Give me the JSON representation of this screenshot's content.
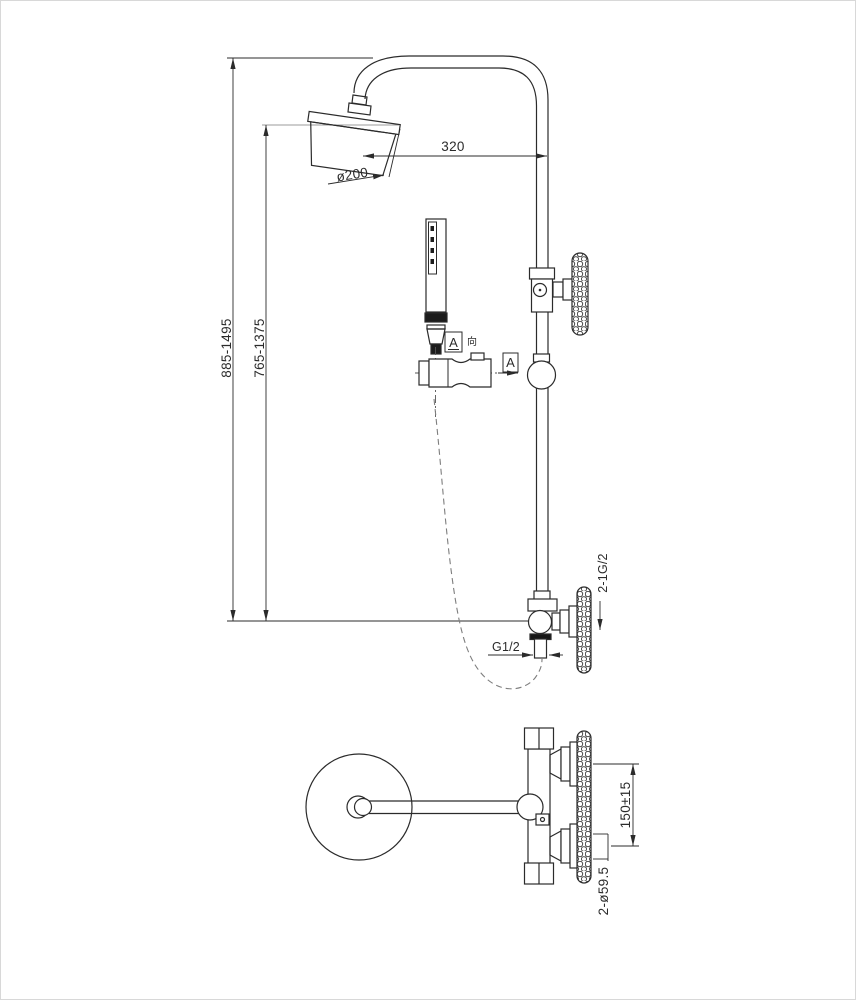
{
  "meta": {
    "drawing_type": "shower-column-technical-drawing",
    "background": "#ffffff",
    "line_color": "#2b2b2b",
    "gray_line_color": "#9b9b9b",
    "hose_color": "#7e7e7e"
  },
  "front_view": {
    "dim_arm_length": "320",
    "dim_head_diameter": "ø200",
    "dim_overall_height": "885-1495",
    "dim_rail_height": "765-1375",
    "dim_outlet_thread": "G1/2",
    "dim_wall_inlets": "2-1G/2",
    "section_a": {
      "letter": "A",
      "direction_char": "向",
      "arrow_letter": "A"
    }
  },
  "top_view": {
    "dim_inlet_spacing": "150±15",
    "dim_escutcheon_diameter": "2-ø59.5"
  }
}
